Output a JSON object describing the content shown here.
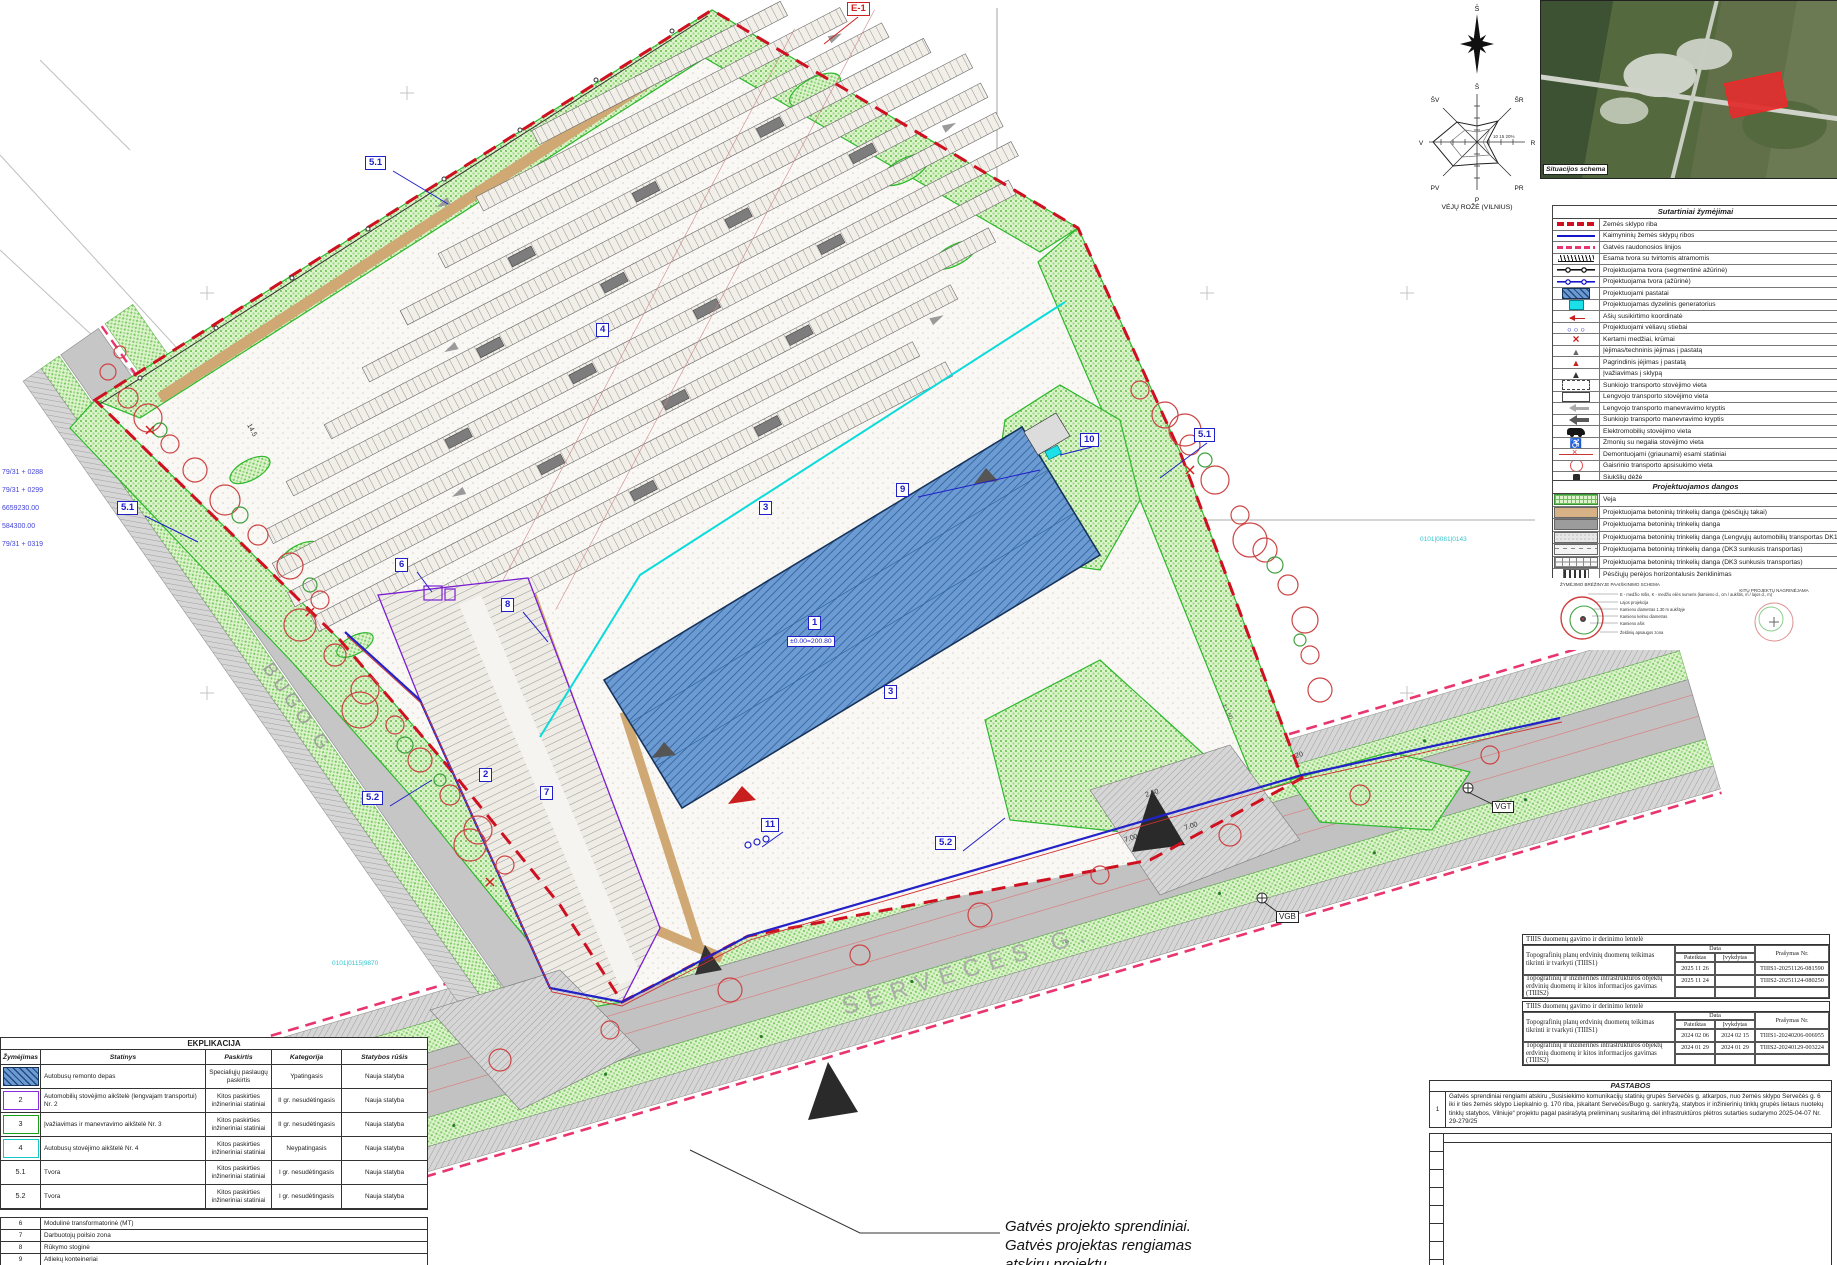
{
  "drawing": {
    "labels": {
      "e1": "E-1",
      "b1": "1",
      "b2": "2",
      "b3": "3",
      "b4": "4",
      "b6": "6",
      "b7": "7",
      "b8": "8",
      "b9": "9",
      "b10": "10",
      "b11": "11",
      "f51": "5.1",
      "f52": "5.2",
      "vgt": "VGT",
      "vgb": "VGB",
      "elevation": "±0.00=200.80"
    },
    "streets": {
      "bugo": "BUGO G.",
      "serveces": "SERVEČĖS G."
    },
    "street_note": [
      "Gatvės projekto sprendiniai.",
      "Gatvės projektas rengiamas",
      "atskiru projektu"
    ],
    "coord_labels": [
      "79/31 + 0288",
      "79/31 + 0299",
      "6659230.00",
      "584300.00",
      "79/31 + 0319"
    ],
    "grid_labels": [
      "0101|0081|0143",
      "0101|0115|9870"
    ],
    "dimensions": [
      "2.50",
      "7.00",
      "7.00",
      "20",
      "1:1.50",
      "14.5"
    ]
  },
  "wind_rose": {
    "north": "Š",
    "directions": [
      "Š",
      "ŠR",
      "R",
      "PR",
      "P",
      "PV",
      "V",
      "ŠV"
    ],
    "scale": "10 15 20%",
    "caption": "VĖJŲ ROŽĖ (VILNIUS)"
  },
  "situation_map": {
    "label": "Situacijos schema"
  },
  "legend": {
    "title": "Sutartiniai žymėjimai",
    "items": [
      {
        "label": "Žemės sklypo riba",
        "sym": "red-dash"
      },
      {
        "label": "Kaimyninių žemės sklypų ribos",
        "sym": "blue-line"
      },
      {
        "label": "Gatvės raudonosios linijos",
        "sym": "magenta-dash"
      },
      {
        "label": "Esama tvora su tvirtomis atramomis",
        "sym": "fence-exist"
      },
      {
        "label": "Projektuojama tvora (segmentinė ažūrinė)",
        "sym": "fence-seg"
      },
      {
        "label": "Projektuojama tvora (ažūrinė)",
        "sym": "fence-blue"
      },
      {
        "label": "Projektuojami pastatai",
        "sym": "bldg"
      },
      {
        "label": "Projektuojamas dyzelinis generatorius",
        "sym": "dg"
      },
      {
        "label": "Ašių susikirtimo koordinatė",
        "sym": "axis"
      },
      {
        "label": "Projektuojami vėliavų stiebai",
        "sym": "flags"
      },
      {
        "label": "Kertami medžiai, krūmai",
        "sym": "cut-tree"
      },
      {
        "label": "Įėjimas/techninis įėjimas į pastatą",
        "sym": "entry-tech"
      },
      {
        "label": "Pagrindinis įėjimas į pastatą",
        "sym": "entry-main"
      },
      {
        "label": "Įvažiavimas į sklypą",
        "sym": "entry-site"
      },
      {
        "label": "Sunkiojo transporto stovėjimo vieta",
        "sym": "truck-park"
      },
      {
        "label": "Lengvojo transporto stovėjimo vieta",
        "sym": "car-park"
      },
      {
        "label": "Lengvojo transporto manevravimo kryptis",
        "sym": "dir-light"
      },
      {
        "label": "Sunkiojo transporto manevravimo kryptis",
        "sym": "dir-heavy"
      },
      {
        "label": "Elektromobilių stovėjimo vieta",
        "sym": "ev"
      },
      {
        "label": "Žmonių su negalia stovėjimo vieta",
        "sym": "disabled"
      },
      {
        "label": "Demontuojami (griaunami) esami statiniai",
        "sym": "demolish"
      },
      {
        "label": "Gaisrinio transporto apsisukimo vieta",
        "sym": "fire"
      },
      {
        "label": "Šiukšlių dėžė",
        "sym": "trash"
      },
      {
        "label": "Suoliukas",
        "sym": "bench"
      },
      {
        "label": "Batų valymo grotelės",
        "sym": "grate"
      }
    ]
  },
  "surfaces": {
    "title": "Projektuojamos dangos",
    "items": [
      {
        "label": "Veja",
        "sym": "veja"
      },
      {
        "label": "Projektuojama betoninių trinkelių danga (pėsčiųjų takai)",
        "sym": "tan"
      },
      {
        "label": "Projektuojama betoninių trinkelių danga",
        "sym": "gray"
      },
      {
        "label": "Projektuojama betoninių trinkelių danga (Lengvųjų automobilių transportas DK1)",
        "sym": "dk1"
      },
      {
        "label": "Projektuojama betoninių trinkelių danga (DK3 sunkusis transportas)",
        "sym": "dk3a"
      },
      {
        "label": "Projektuojama betoninių trinkelių danga (DK3 sunkusis transportas)",
        "sym": "dk3b"
      },
      {
        "label": "Pėsčiųjų perėjos horizontalusis ženklinimas",
        "sym": "crosswalk"
      }
    ]
  },
  "schemas": {
    "left_title": "ŽYMĖJIMO BRĖŽINYJE PAAIŠKINIMO SCHEMA",
    "right_title": "KITŲ PROJEKTŲ NAGRINĖJAMA",
    "left_labels": [
      "E - medžio rūšis, K - medžio eilės numeris (kamieno d., cm / aukštis, m / lajos d., m)",
      "Lajos projekcija",
      "Kamieno diametras 1.30 m aukštyje",
      "Kamieno kelmo diametras",
      "Kamieno ašis",
      "Želdinių apsaugos zona"
    ]
  },
  "tiiis": {
    "tables": [
      {
        "title": "TIIIS duomenų gavimo ir derinimo lentelė",
        "col_data": "Data",
        "col_submitted": "Pateiktas",
        "col_done": "Įvykdytas",
        "col_request": "Prašymas Nr.",
        "rows": [
          {
            "desc": "Topografinių planų erdvinių duomenų teikimas tikrinti ir tvarkyti (TIIIS1)",
            "submitted": "2025 11 26",
            "done": "",
            "request": "TIIIS1-20251126-081590"
          },
          {
            "desc": "Topografinių ir inžinerinės infrastruktūros objektų erdvinių duomenų ir kitos informacijos gavimas (TIIIS2)",
            "submitted": "2025 11 24",
            "done": "",
            "request": "TIIIS2-20251124-080250"
          }
        ]
      },
      {
        "title": "TIIIS duomenų gavimo ir derinimo lentelė",
        "col_data": "Data",
        "col_submitted": "Pateiktas",
        "col_done": "Įvykdytas",
        "col_request": "Prašymas Nr.",
        "rows": [
          {
            "desc": "Topografinių planų erdvinių duomenų teikimas tikrinti ir tvarkyti (TIIIS1)",
            "submitted": "2024 02 06",
            "done": "2024 02 15",
            "request": "TIIIS1-20240206-006955"
          },
          {
            "desc": "Topografinių ir inžinerinės infrastruktūros objektų erdvinių duomenų ir kitos informacijos gavimas (TIIIS2)",
            "submitted": "2024 01 29",
            "done": "2024 01 29",
            "request": "TIIIS2-20240129-003224"
          }
        ]
      }
    ]
  },
  "pastabos": {
    "title": "PASTABOS",
    "notes": [
      {
        "num": "1",
        "text": "Gatvės sprendiniai rengiami atskiru „Susisiekimo komunikacijų statinių grupės Servečės g. atkarpos, nuo žemės sklypo Servečės g. 6 iki ir ties žemės sklypo Liepkalnio g. 170 riba, įskaitant Servečės/Bugo g. sankryžą, statybos ir inžinierinių tinklų grupės lietaus nuotekų tinklų statybos, Vilniuje“ projektu pagal pasirašytą preliminarų susitarimą dėl infrastruktūros plėtros sutarties sudarymo 2025-04-07 Nr. 29-279/25"
      }
    ]
  },
  "eksplikacija": {
    "title": "EKPLIKACIJA",
    "headers": [
      "Žymėjimas",
      "Statinys",
      "Paskirtis",
      "Kategorija",
      "Statybos rūšis"
    ],
    "rows": [
      {
        "num": "",
        "sym": "e1",
        "statinys": "Autobusų remonto depas",
        "paskirtis": "Specialiųjų paslaugų paskirtis",
        "kategorija": "Ypatingasis",
        "rusis": "Nauja statyba"
      },
      {
        "num": "2",
        "sym": "e2",
        "statinys": "Automobilių stovėjimo aikštelė (lengvajam transportui) Nr. 2",
        "paskirtis": "Kitos paskirties inžineriniai statiniai",
        "kategorija": "II gr. nesudėtingasis",
        "rusis": "Nauja statyba"
      },
      {
        "num": "3",
        "sym": "e3",
        "statinys": "Įvažiavimas ir manevravimo aikštelė Nr. 3",
        "paskirtis": "Kitos paskirties inžineriniai statiniai",
        "kategorija": "II gr. nesudėtingasis",
        "rusis": "Nauja statyba"
      },
      {
        "num": "4",
        "sym": "e4",
        "statinys": "Autobusų stovėjimo aikštelė Nr. 4",
        "paskirtis": "Kitos paskirties inžineriniai statiniai",
        "kategorija": "Neypatingasis",
        "rusis": "Nauja statyba"
      },
      {
        "num": "5.1",
        "sym": "none",
        "statinys": "Tvora",
        "paskirtis": "Kitos paskirties inžineriniai statiniai",
        "kategorija": "I gr. nesudėtingasis",
        "rusis": "Nauja statyba"
      },
      {
        "num": "5.2",
        "sym": "none",
        "statinys": "Tvora",
        "paskirtis": "Kitos paskirties inžineriniai statiniai",
        "kategorija": "I gr. nesudėtingasis",
        "rusis": "Nauja statyba"
      }
    ],
    "extra_rows": [
      {
        "num": "6",
        "text": "Modulinė transformatorinė (MT)"
      },
      {
        "num": "7",
        "text": "Darbuotojų poilsio zona"
      },
      {
        "num": "8",
        "text": "Rūkymo stoginė"
      },
      {
        "num": "9",
        "text": "Atliekų konteineriai"
      },
      {
        "num": "10",
        "text": "Dyzelinis generatorius"
      },
      {
        "num": "11",
        "text": "Vėliavos stiebas"
      },
      {
        "num": "VGT",
        "text": "Projektuojamas vandens gręžinys technologijai"
      }
    ]
  },
  "colors": {
    "boundary_red": "#cf1020",
    "red_line_pink": "#e8356d",
    "neighbor_blue": "#1414c8",
    "building_blue": "#6b9bd2",
    "fence_blue": "#2222c8",
    "green": "#5cb84c",
    "cyan": "#0adbdb",
    "purple": "#7a1fd0",
    "tan": "#d0a873"
  }
}
